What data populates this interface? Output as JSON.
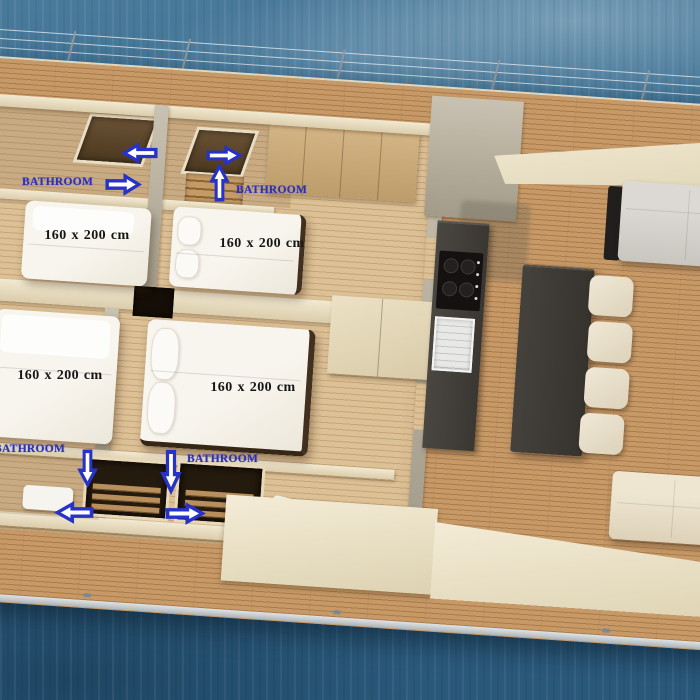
{
  "cabins": [
    {
      "bed_size_label": "160 x 200 cm"
    },
    {
      "bed_size_label": "160 x 200 cm"
    },
    {
      "bed_size_label": "160 x 200 cm"
    },
    {
      "bed_size_label": "160 x 200 cm"
    }
  ],
  "bathroom_annotations": [
    {
      "label": "BATHROOM",
      "arrow_icons": [
        "arrow-left-icon",
        "arrow-right-icon"
      ]
    },
    {
      "label": "BATHROOM",
      "arrow_icons": [
        "arrow-right-icon",
        "arrow-up-icon"
      ]
    },
    {
      "label": "BATHROOM",
      "arrow_icons": [
        "arrow-down-icon",
        "arrow-left-icon"
      ]
    },
    {
      "label": "BATHROOM",
      "arrow_icons": [
        "arrow-down-icon",
        "arrow-right-icon"
      ]
    }
  ],
  "colors": {
    "annotation_blue": "#2a2fbe",
    "bed_label_black": "#161616",
    "water_blue": "#336386",
    "teak_deck": "#c79967",
    "interior_wood": "#dcc096",
    "wall_cream": "#eadfc6",
    "kitchen_counter": "#3a3733",
    "kitchen_island": "#36332f",
    "bed_white": "#f8f5ee",
    "sofa_gray": "#d2cfca",
    "sofa_cream": "#eadfc8",
    "stool_cream": "#eae1cd"
  }
}
